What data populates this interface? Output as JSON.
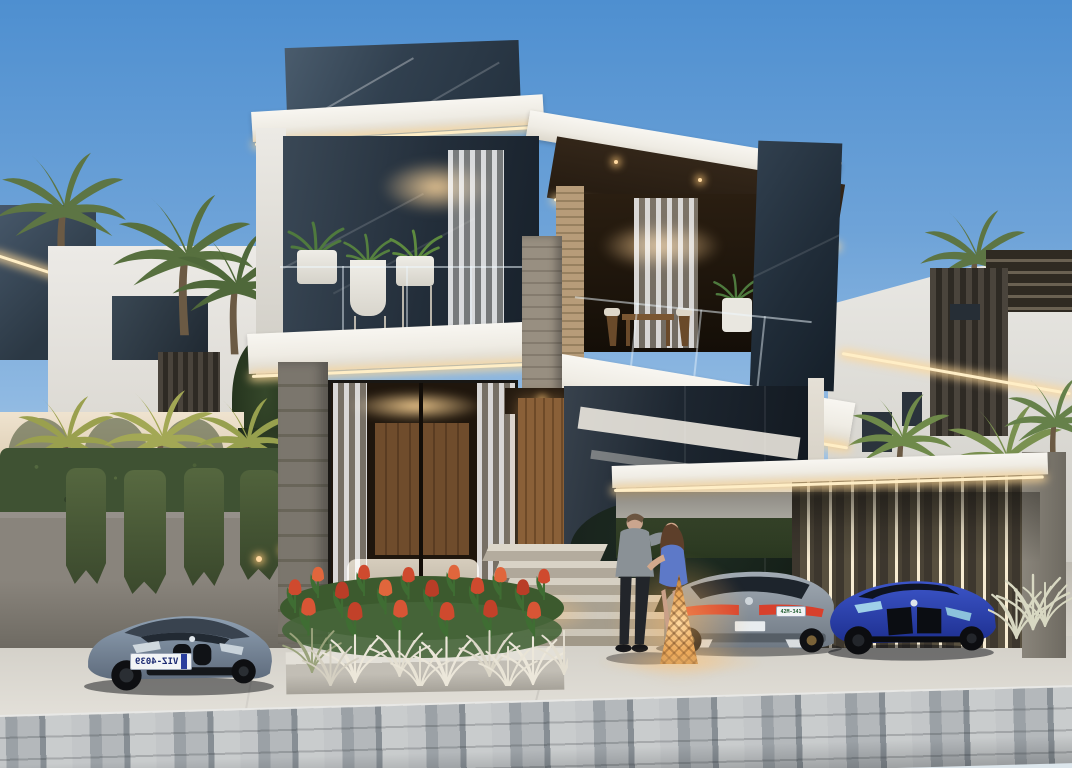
{
  "scene": {
    "description": "Dusk architectural rendering of a modern two-storey luxury villa with warm LED-lit white roof fascias, dark marble panels, glass walls, balcony planters, a carport with LED slat wall, three parked cars, an embracing couple with a glowing wicker lantern, tulip flower beds, palm trees and white neighbouring villas",
    "time_of_day": "dusk"
  },
  "palette": {
    "sky_top": "#4e8fd0",
    "sky_horizon": "#dce6ec",
    "fascia_white": "#f5f2ec",
    "led_warm": "#ffeec6",
    "marble_dark": "#31404f",
    "wood_soffit": "#2e2115",
    "door_wood": "#7a5836",
    "glass_dark": "#1c242d",
    "stone_wall": "#7f7a71",
    "concrete_drive": "#d8d5cd",
    "paver_gray": "#9aa0a5",
    "hedge_green": "#43552f",
    "palm_green": "#5c7544",
    "palm_warm_lit": "#a3a052",
    "tulip_red": "#cf4a2e",
    "grass_plume_white": "#e9e4d6",
    "lantern_glow": "#ffc37a"
  },
  "cars": {
    "left": {
      "type": "luxury coupe, front view",
      "color_name": "gray-blue",
      "color": "#7e8da0",
      "plate_text": "VIZ-4039",
      "plate_mirrored": "true"
    },
    "middle": {
      "type": "luxury coupe, rear view",
      "color_name": "gray",
      "color": "#8f99a3",
      "plate_text": "42M-341"
    },
    "right": {
      "type": "sports coupe, front view",
      "color_name": "blue",
      "color": "#2742b8"
    }
  },
  "people": {
    "description": "man in gray shirt and dark trousers embracing woman in blue dress with long brown hair, standing by the entrance steps"
  },
  "lighting": {
    "fascia_led": "warm LED strips under every white roof fascia",
    "carport": "vertical LED light strips between dark timber slats",
    "lantern": "wicker cone lantern glowing warm at the entrance",
    "interiors": "warm cove lighting inside all rooms"
  }
}
